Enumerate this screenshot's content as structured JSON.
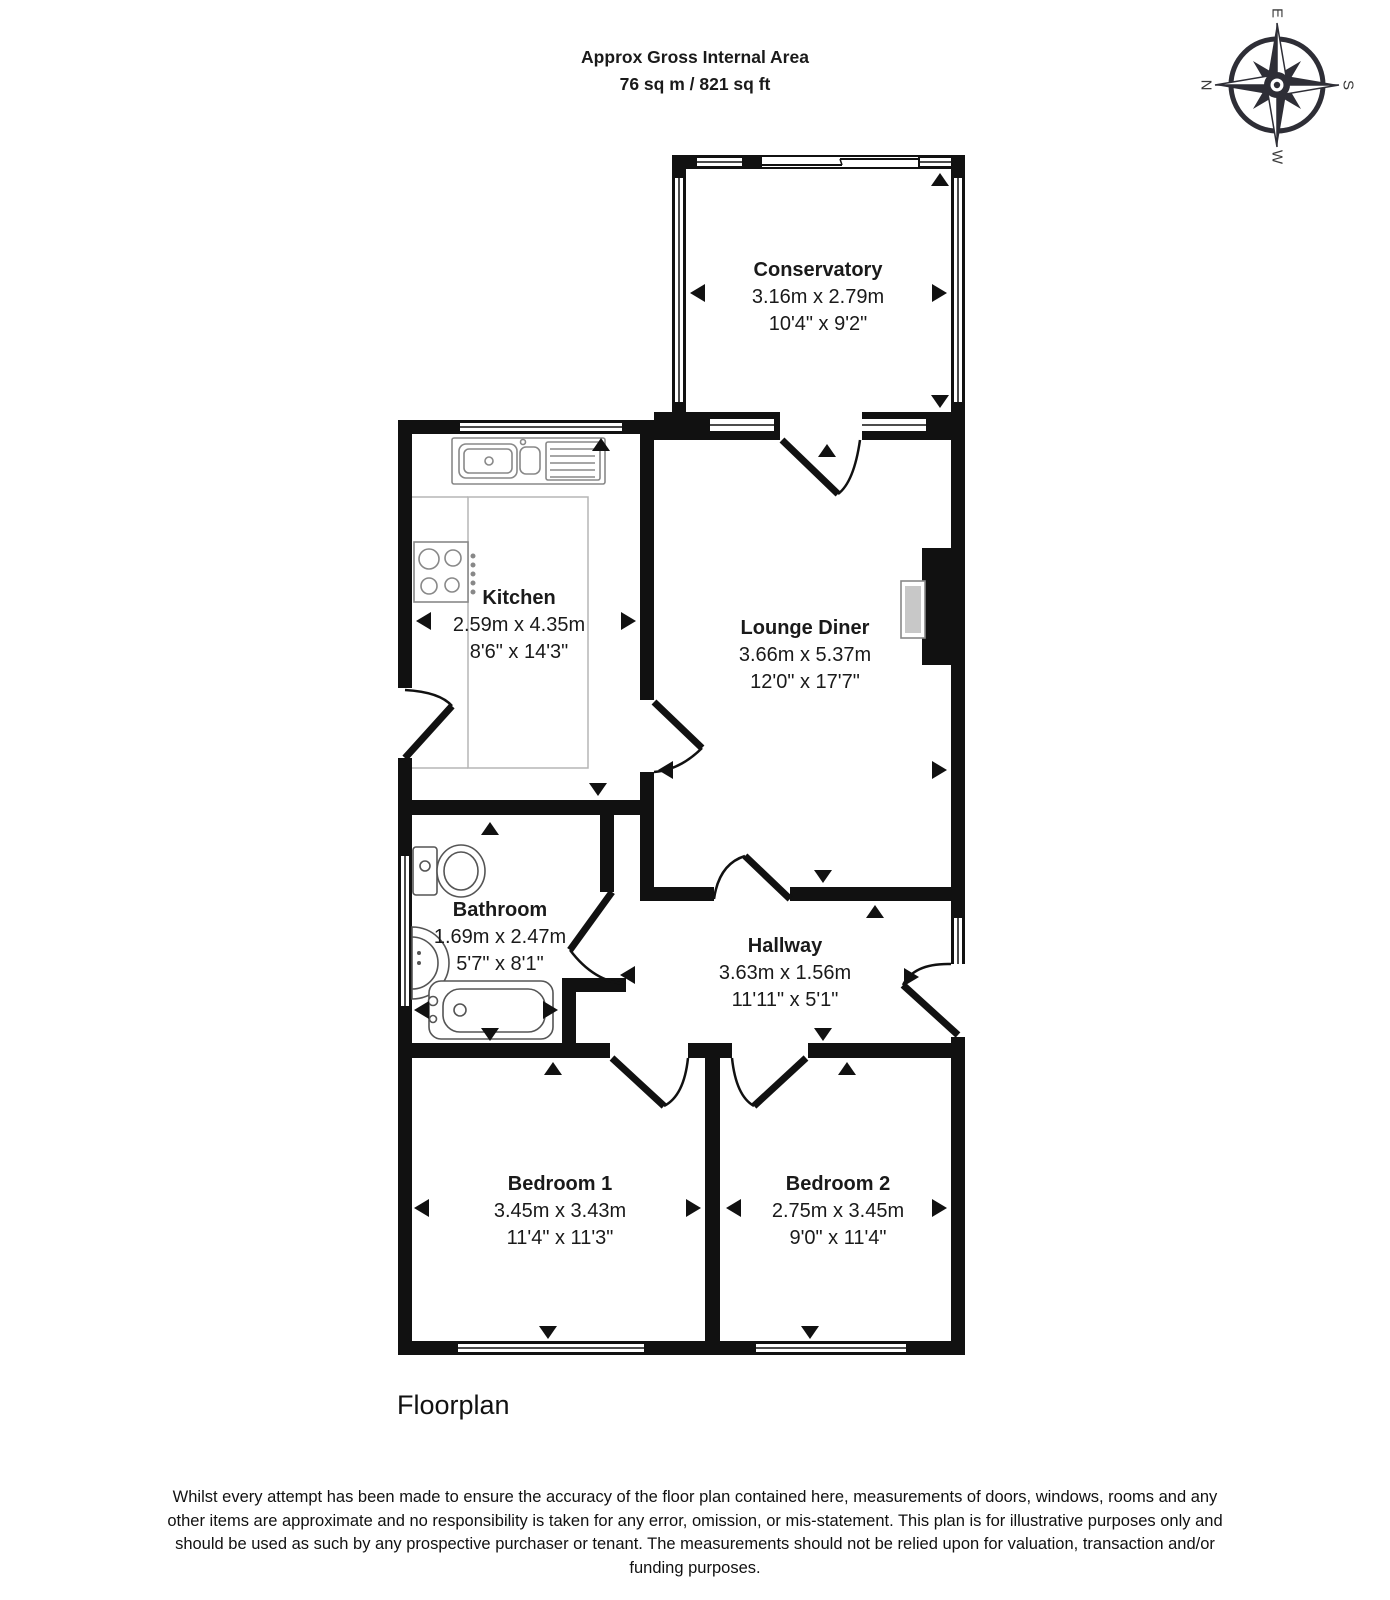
{
  "header": {
    "title_line1": "Approx Gross Internal Area",
    "title_line2": "76 sq m / 821 sq ft"
  },
  "compass": {
    "north": "N",
    "east": "E",
    "south": "S",
    "west": "W"
  },
  "rooms": [
    {
      "name": "Conservatory",
      "metric": "3.16m x 2.79m",
      "imperial": "10'4\" x 9'2\""
    },
    {
      "name": "Kitchen",
      "metric": "2.59m x 4.35m",
      "imperial": "8'6\" x 14'3\""
    },
    {
      "name": "Lounge Diner",
      "metric": "3.66m x 5.37m",
      "imperial": "12'0\" x 17'7\""
    },
    {
      "name": "Bathroom",
      "metric": "1.69m x 2.47m",
      "imperial": "5'7\" x 8'1\""
    },
    {
      "name": "Hallway",
      "metric": "3.63m x 1.56m",
      "imperial": "11'11\" x 5'1\""
    },
    {
      "name": "Bedroom 1",
      "metric": "3.45m x 3.43m",
      "imperial": "11'4\" x 11'3\""
    },
    {
      "name": "Bedroom 2",
      "metric": "2.75m x 3.45m",
      "imperial": "9'0\" x 11'4\""
    }
  ],
  "footer": {
    "caption": "Floorplan",
    "disclaimer": "Whilst every attempt has been made to ensure the accuracy of the floor plan contained here, measurements of doors, windows, rooms and any other items are approximate and no responsibility is taken for any error, omission, or mis-statement. This plan is for illustrative purposes only and should be used as such by any prospective purchaser or tenant. The measurements should not be relied upon for valuation, transaction and/or funding purposes."
  },
  "colors": {
    "wall": "#111111",
    "background": "#ffffff",
    "fixture": "#888888",
    "hearth": "#c8c8c8"
  }
}
